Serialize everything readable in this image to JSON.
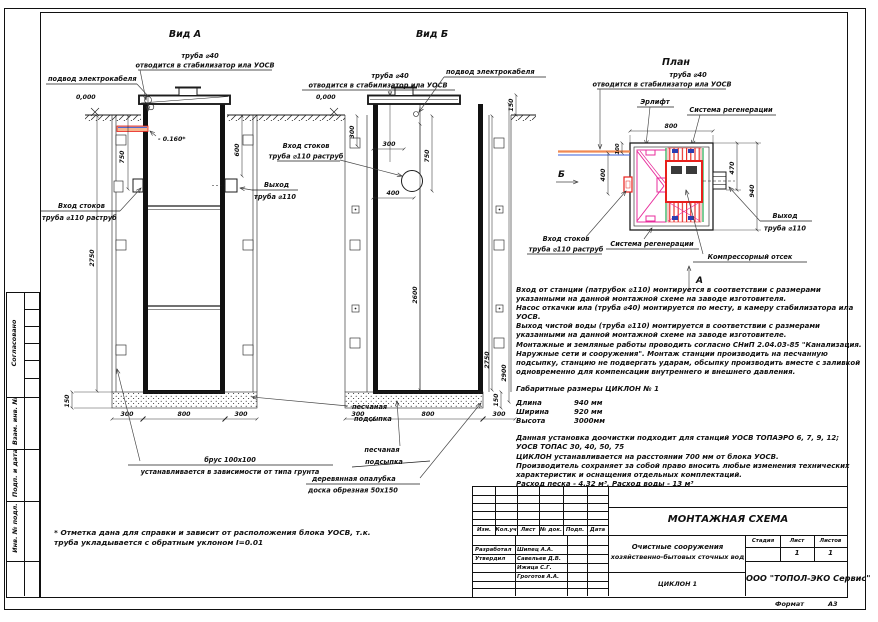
{
  "views": {
    "a": "Вид А",
    "b": "Вид Б",
    "plan": "План"
  },
  "marks": {
    "zero": "0,000",
    "minus": "- 0.160*"
  },
  "labels": {
    "pipe40_l1": "труба ⌀40",
    "pipe40_l2": "отводится в стабилизатор ила УОСВ",
    "cable": "подвод электрокабеля",
    "inlet_l1": "Вход стоков",
    "inlet_l2": "труба ⌀110 раструб",
    "outlet_l1": "Выход",
    "outlet_l2": "труба ⌀110",
    "sand_l1": "песчаная",
    "sand_l2": "подсыпка",
    "brus_l1": "брус 100х100",
    "brus_l2": "устанавливается в зависимости от типа грунта",
    "formwork_l1": "деревянная опалубка",
    "formwork_l2": "доска обрезная 50х150",
    "airlift": "Эрлифт",
    "regen": "Система регенерации",
    "compressor": "Компрессорный отсек",
    "dir_b": "Б",
    "dir_a": "А"
  },
  "dims": {
    "d750": "750",
    "d2750": "2750",
    "d600": "600",
    "d300": "300",
    "d800": "800",
    "d150": "150",
    "d2600": "2600",
    "d2900": "2900",
    "d400": "400",
    "d940": "940",
    "d470": "470",
    "d100": "100"
  },
  "notes": {
    "p1": "Вход от станции (патрубок ⌀110) монтируется в соответствии с размерами указанными на данной монтажной схеме на заводе изготовителя.",
    "p2": "Насос откачки ила (труба ⌀40) монтируется по месту, в камеру стабилизатора ила УОСВ.",
    "p3": "Выход чистой воды (труба ⌀110) монтируется в соответствии с размерами указанными на данной монтажной схеме на заводе изготовителе.",
    "p4": "Монтажные и земляные работы проводить согласно СНиП 2.04.03-85 \"Канализация. Наружные сети и сооружения\". Монтаж станции производить на песчанную подсыпку, станцию не подвергать ударам, обсыпку производить вместе с заливкой одновременно для компенсации внутреннего и внешнего давления.",
    "dims_heading": "Габаритные размеры ЦИКЛОН № 1",
    "p5": "Данная установка доочистки подходит для станций УОСВ ТОПАЭРО 6, 7, 9, 12; УОСВ ТОПАС 30, 40, 50, 75",
    "p6": "ЦИКЛОН устанавливается на расстоянии 700 мм от блока УОСВ.",
    "p7": "Производитель сохраняет за собой право вносить любые изменения технических характеристик и оснащения отдельных комплектаций.",
    "p8": "Расход песка - 4.32 м³, Расход воды - 13 м³"
  },
  "sizes": {
    "rows": [
      {
        "label": "Длина",
        "value": "940 мм"
      },
      {
        "label": "Ширина",
        "value": "920 мм"
      },
      {
        "label": "Высота",
        "value": "3000мм"
      }
    ]
  },
  "footnote": "* Отметка дана для справки и зависит от расположения блока УОСВ, т.к. труба укладывается с обратным уклоном I=0.01",
  "margin": {
    "approved": "Согласовано",
    "inv_repl": "Взам. инв. №",
    "sign_date": "Подп. и дата",
    "inv_orig": "Инв. № подл."
  },
  "titleblock": {
    "header_cols": [
      "Изм.",
      "Кол.уч",
      "Лист",
      "№ док.",
      "Подп.",
      "Дата"
    ],
    "rows": [
      {
        "role": "Разработал",
        "name": "Шипец А.А."
      },
      {
        "role": "Утвердил",
        "name": "Савельев Д.В."
      },
      {
        "role": "",
        "name": "Ижица С.Г."
      },
      {
        "role": "",
        "name": "Гроготов А.А."
      }
    ],
    "scheme_title": "МОНТАЖНАЯ СХЕМА",
    "object_l1": "Очистные сооружения",
    "object_l2": "хозяйственно-бытовых сточных вод",
    "doc": "ЦИКЛОН 1",
    "stage_label": "Стадия",
    "sheet_label": "Лист",
    "sheets_label": "Листов",
    "sheet_no": "1",
    "sheets_total": "1",
    "company": "ООО \"ТОПОЛ-ЭКО Сервис\"",
    "format_label": "Формат",
    "format_value": "А3"
  },
  "colors": {
    "line": "#1c1c1c",
    "red": "#e8201c",
    "magenta": "#e82c9c",
    "green": "#1faa4e",
    "blue": "#2b3db1",
    "orange": "#f08a54"
  }
}
